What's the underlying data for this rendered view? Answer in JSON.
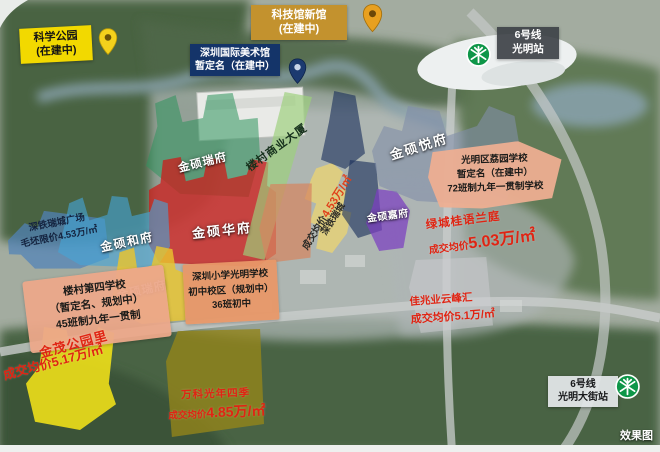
{
  "badges": {
    "science_park": {
      "lines": [
        "科学公园",
        "(在建中)"
      ]
    },
    "science_museum_new": {
      "lines": [
        "科技馆新馆",
        "(在建中)"
      ]
    },
    "art_museum": {
      "lines": [
        "深圳国际美术馆",
        "暂定名（在建中）"
      ]
    },
    "metro_line6_guangming": {
      "lines": [
        "6号线",
        "光明站"
      ]
    },
    "metro_line6_guangming_street": {
      "lines": [
        "6号线",
        "光明大街站"
      ]
    }
  },
  "parcels": {
    "jinshuo_ruifu_north": {
      "label": "金硕瑞府"
    },
    "jinshuo_huafu": {
      "label": "金硕华府"
    },
    "jinshuo_hefu": {
      "label": "金硕和府"
    },
    "jinshuo_yuefu": {
      "label": "金硕悦府"
    },
    "jinshuo_jiafu": {
      "label": "金硕嘉府"
    },
    "jinshuo_ruifu_south": {
      "label": "金硕瑞府"
    },
    "loucun_commercial": {
      "label": "楼村商业大厦"
    },
    "shentie_plaza": {
      "name": "深铁瑞城广场",
      "price": "毛坯限价4.53万/㎡"
    },
    "shentie_ruicheng": {
      "name": "深铁瑞城",
      "price_prefix": "成交均价",
      "price_value": "4.53万/㎡"
    },
    "liyuan_school": {
      "lines": [
        "光明区荔园学校",
        "暂定名（在建中）",
        "72班制九年一贯制学校"
      ]
    },
    "lvcheng_guiyu_lanting": {
      "name": "绿城桂语兰庭",
      "price_prefix": "成交均价",
      "price_value": "5.03万/㎡"
    },
    "jiazhaoye_yunfenghui": {
      "name": "佳兆业云峰汇",
      "price": "成交均价5.1万/㎡"
    },
    "loucun_no4_school": {
      "lines": [
        "楼村第四学校",
        "（暂定名、规划中）",
        "45班制九年一贯制"
      ]
    },
    "shenzhen_primary_guangming": {
      "lines": [
        "深圳小学光明学校",
        "初中校区（规划中）",
        "36班初中"
      ]
    },
    "jinmao_gongyuanli": {
      "name": "金茂公园里",
      "price": "成交均价5.17万/㎡"
    },
    "vanke_guangnian": {
      "name": "万科光年四季",
      "price_prefix": "成交均价",
      "price_value": "4.85万/㎡"
    }
  },
  "watermark": "效果图",
  "colors": {
    "badge_yellow": "#f2d900",
    "badge_gold": "#c3922e",
    "badge_navy": "#143469",
    "metro_green": "#0e9648",
    "parcel_red": "#cd1c19",
    "parcel_green": "#2e945c",
    "parcel_cyan": "#46a5d7",
    "parcel_yellow": "#e9c52e",
    "parcel_gray_blue": "#808ea8",
    "parcel_purple": "#7c3ec0",
    "parcel_salmon": "#eeae92",
    "price_red": "#e02413"
  }
}
